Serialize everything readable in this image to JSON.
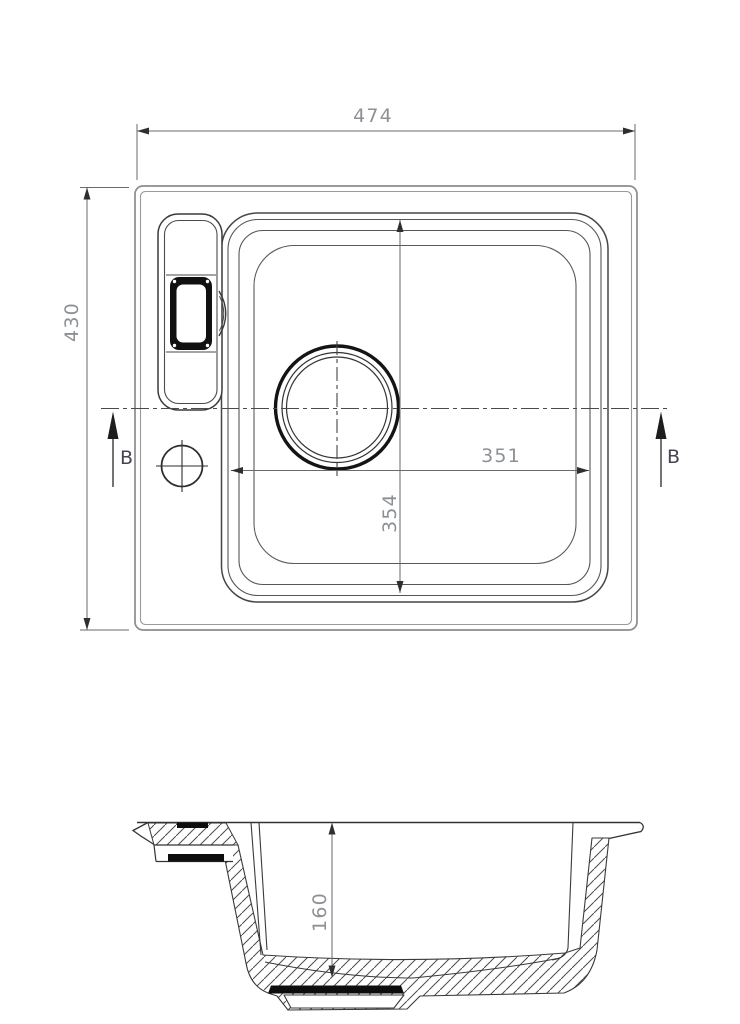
{
  "drawing": {
    "dimensions": {
      "overall_width": "474",
      "overall_depth": "430",
      "bowl_width": "351",
      "bowl_depth": "354",
      "bowl_height": "160"
    },
    "section_markers": {
      "left": "B",
      "right": "B"
    },
    "colors": {
      "line": "#3a3a3a",
      "outer_edge": "#8c8c8c",
      "dim_line": "#6a6a6a",
      "dim_text": "#8d9196",
      "marker_text": "#45444f",
      "fill_black": "#0d0d0d"
    }
  }
}
